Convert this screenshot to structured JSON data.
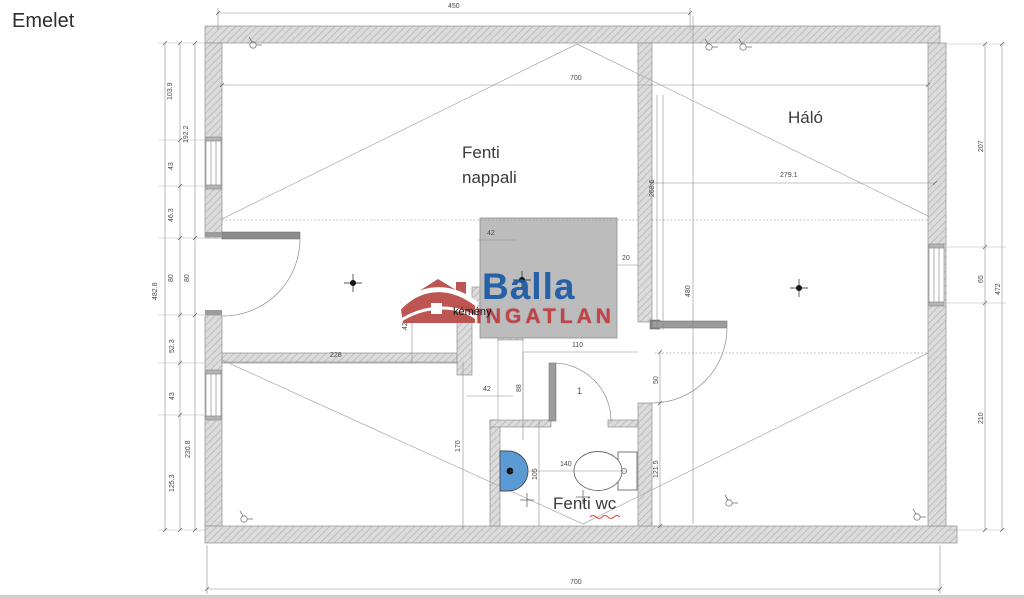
{
  "labels": {
    "title": "Emelet",
    "living_line1": "Fenti",
    "living_line2": "nappali",
    "bedroom": "Háló",
    "wc": "Fenti wc",
    "chimney": "kémény",
    "door_number": "1"
  },
  "logo": {
    "name": "Balla",
    "subtitle": "INGATLAN"
  },
  "dims": {
    "top_width": "450",
    "interior_width": "700",
    "bottom_width": "700",
    "bedroom_width": "279.1",
    "bedroom_height": "268.5",
    "hall_height": "480",
    "right_top": "207",
    "right_window": "65",
    "right_bottom": "210",
    "right_total": "472",
    "left_1": "103.9",
    "left_2": "192.2",
    "left_3": "43",
    "left_4": "46.3",
    "left_5": "80",
    "left_6": "80",
    "left_7": "52.3",
    "left_8": "43",
    "left_9": "230.8",
    "left_10": "125.3",
    "left_total": "482.8",
    "room_width": "228",
    "wc_wall_height": "170",
    "shaft_width": "110",
    "chimney_top": "42",
    "shaft_side": "42",
    "shaft_bottom": "42",
    "shaft_height": "88",
    "gap": "20",
    "wc_width": "140",
    "wc_depth": "105",
    "hall_seg": "50",
    "hall_lower": "121.5"
  },
  "colors": {
    "wall_fill": "#dcdcdc",
    "wall_hatch": "#aaaaaa",
    "chimney_block": "#bcbcbc",
    "sink_blue": "#5b9bd5",
    "logo_blue": "#1b5ba6",
    "logo_red": "#b94a47",
    "spellcheck_red": "#e04040"
  }
}
